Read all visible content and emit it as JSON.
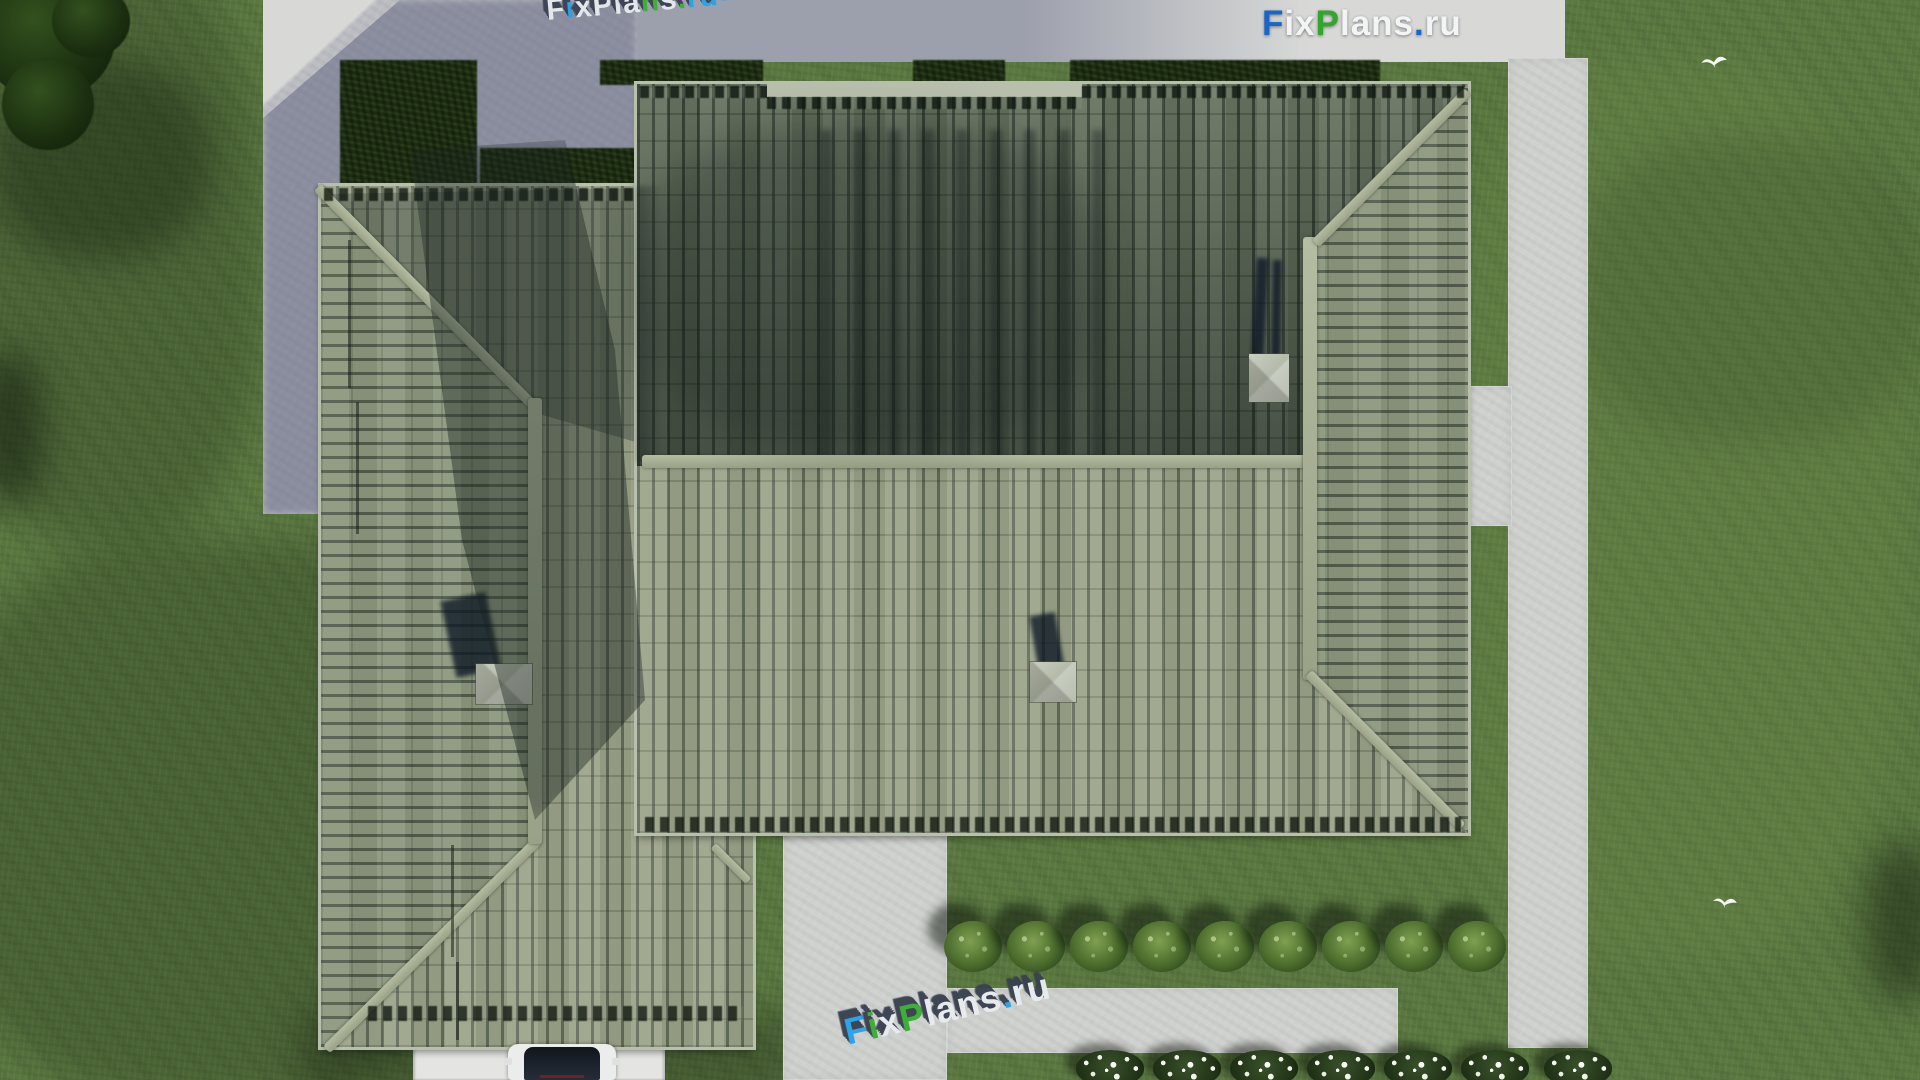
{
  "branding": {
    "logo_top_right": {
      "text": "FixPlans.ru",
      "segments": [
        {
          "ch": "F",
          "color": "logo-blue"
        },
        {
          "ch": "i",
          "color": "logo-white"
        },
        {
          "ch": "x",
          "color": "logo-white"
        },
        {
          "ch": "P",
          "color": "logo-green"
        },
        {
          "ch": "l",
          "color": "logo-white"
        },
        {
          "ch": "a",
          "color": "logo-white"
        },
        {
          "ch": "n",
          "color": "logo-white"
        },
        {
          "ch": "s",
          "color": "logo-white"
        },
        {
          "ch": ".",
          "color": "logo-blue"
        },
        {
          "ch": "r",
          "color": "logo-white"
        },
        {
          "ch": "u",
          "color": "logo-white"
        }
      ]
    }
  },
  "watermarks": {
    "bottom_3d": {
      "text": "FixPlans.ru",
      "rotation_deg": -13,
      "segments": [
        {
          "ch": "F",
          "color": "wm-blue"
        },
        {
          "ch": "i",
          "color": "wm-green"
        },
        {
          "ch": "x",
          "color": "wm-white"
        },
        {
          "ch": "P",
          "color": "wm-green"
        },
        {
          "ch": "l",
          "color": "wm-white"
        },
        {
          "ch": "a",
          "color": "wm-white"
        },
        {
          "ch": "n",
          "color": "wm-white"
        },
        {
          "ch": "s",
          "color": "wm-white"
        },
        {
          "ch": ".",
          "color": "wm-blue"
        },
        {
          "ch": "r",
          "color": "wm-white"
        },
        {
          "ch": "u",
          "color": "wm-white"
        }
      ]
    },
    "top_diagonal": {
      "text": "FixPlans.ru",
      "rotation_deg": -5,
      "clipped_at_top": true,
      "segments": [
        {
          "ch": "F",
          "color": "wm-white"
        },
        {
          "ch": "i",
          "color": "wm-blue"
        },
        {
          "ch": "x",
          "color": "wm-white"
        },
        {
          "ch": "P",
          "color": "wm-white"
        },
        {
          "ch": "l",
          "color": "wm-white"
        },
        {
          "ch": "a",
          "color": "wm-white"
        },
        {
          "ch": "n",
          "color": "wm-green"
        },
        {
          "ch": "s",
          "color": "wm-white"
        },
        {
          "ch": ".",
          "color": "wm-green"
        },
        {
          "ch": "r",
          "color": "wm-blue"
        },
        {
          "ch": "u",
          "color": "wm-blue"
        }
      ]
    }
  },
  "scene": {
    "view": "aerial top-down render of hip-roof house with lawn and concrete paths",
    "house": {
      "wings": [
        "left-wing",
        "main-wing"
      ],
      "chimney_count": 3,
      "skylight_pyramids": 3
    },
    "landscaping": {
      "green_bushes_row": {
        "count": 9,
        "y_center": 947,
        "x_centers": [
          973,
          1036,
          1099,
          1162,
          1225,
          1288,
          1351,
          1414,
          1477
        ]
      },
      "white_flower_bushes_row": {
        "count": 7,
        "y_center": 1068,
        "x_centers": [
          1110,
          1187,
          1264,
          1341,
          1418,
          1495,
          1578
        ]
      },
      "corner_tree_count": 3
    },
    "paths": [
      "top-slab",
      "west-slab",
      "right-path",
      "center-path",
      "horizontal-path",
      "driveway"
    ],
    "vehicles": {
      "car_count": 1
    },
    "birds": {
      "count": 2,
      "positions": [
        [
          1700,
          52
        ],
        [
          1712,
          893
        ]
      ]
    }
  },
  "colors": {
    "grass": "#5a7840",
    "slab": "#bcbdc2",
    "slab-lit": "#d8d9d7",
    "path": "#cfd1ce",
    "drive": "#e4e5e2",
    "roof-south": "#9aa288",
    "roof-north": "#75816c",
    "roof-east": "#8d987e",
    "ridge": "#a9b197",
    "fascia": "#b8bfad",
    "hedge": "#1d2c12",
    "chimney": "#b3bba6",
    "shadow-tint": "#565c7a",
    "logo-blue": "#1766c8",
    "logo-green": "#33a42c",
    "logo-white": "#f2f4f6",
    "wm-blue": "#29a3e8",
    "wm-green": "#3aae34",
    "wm-white": "#e8ecef",
    "wm-top": "#3a4150",
    "car-glass": "#262d38",
    "car-body": "#ebecec",
    "car-taillight": "#8a2020",
    "bird-white": "#fdfdfb"
  }
}
